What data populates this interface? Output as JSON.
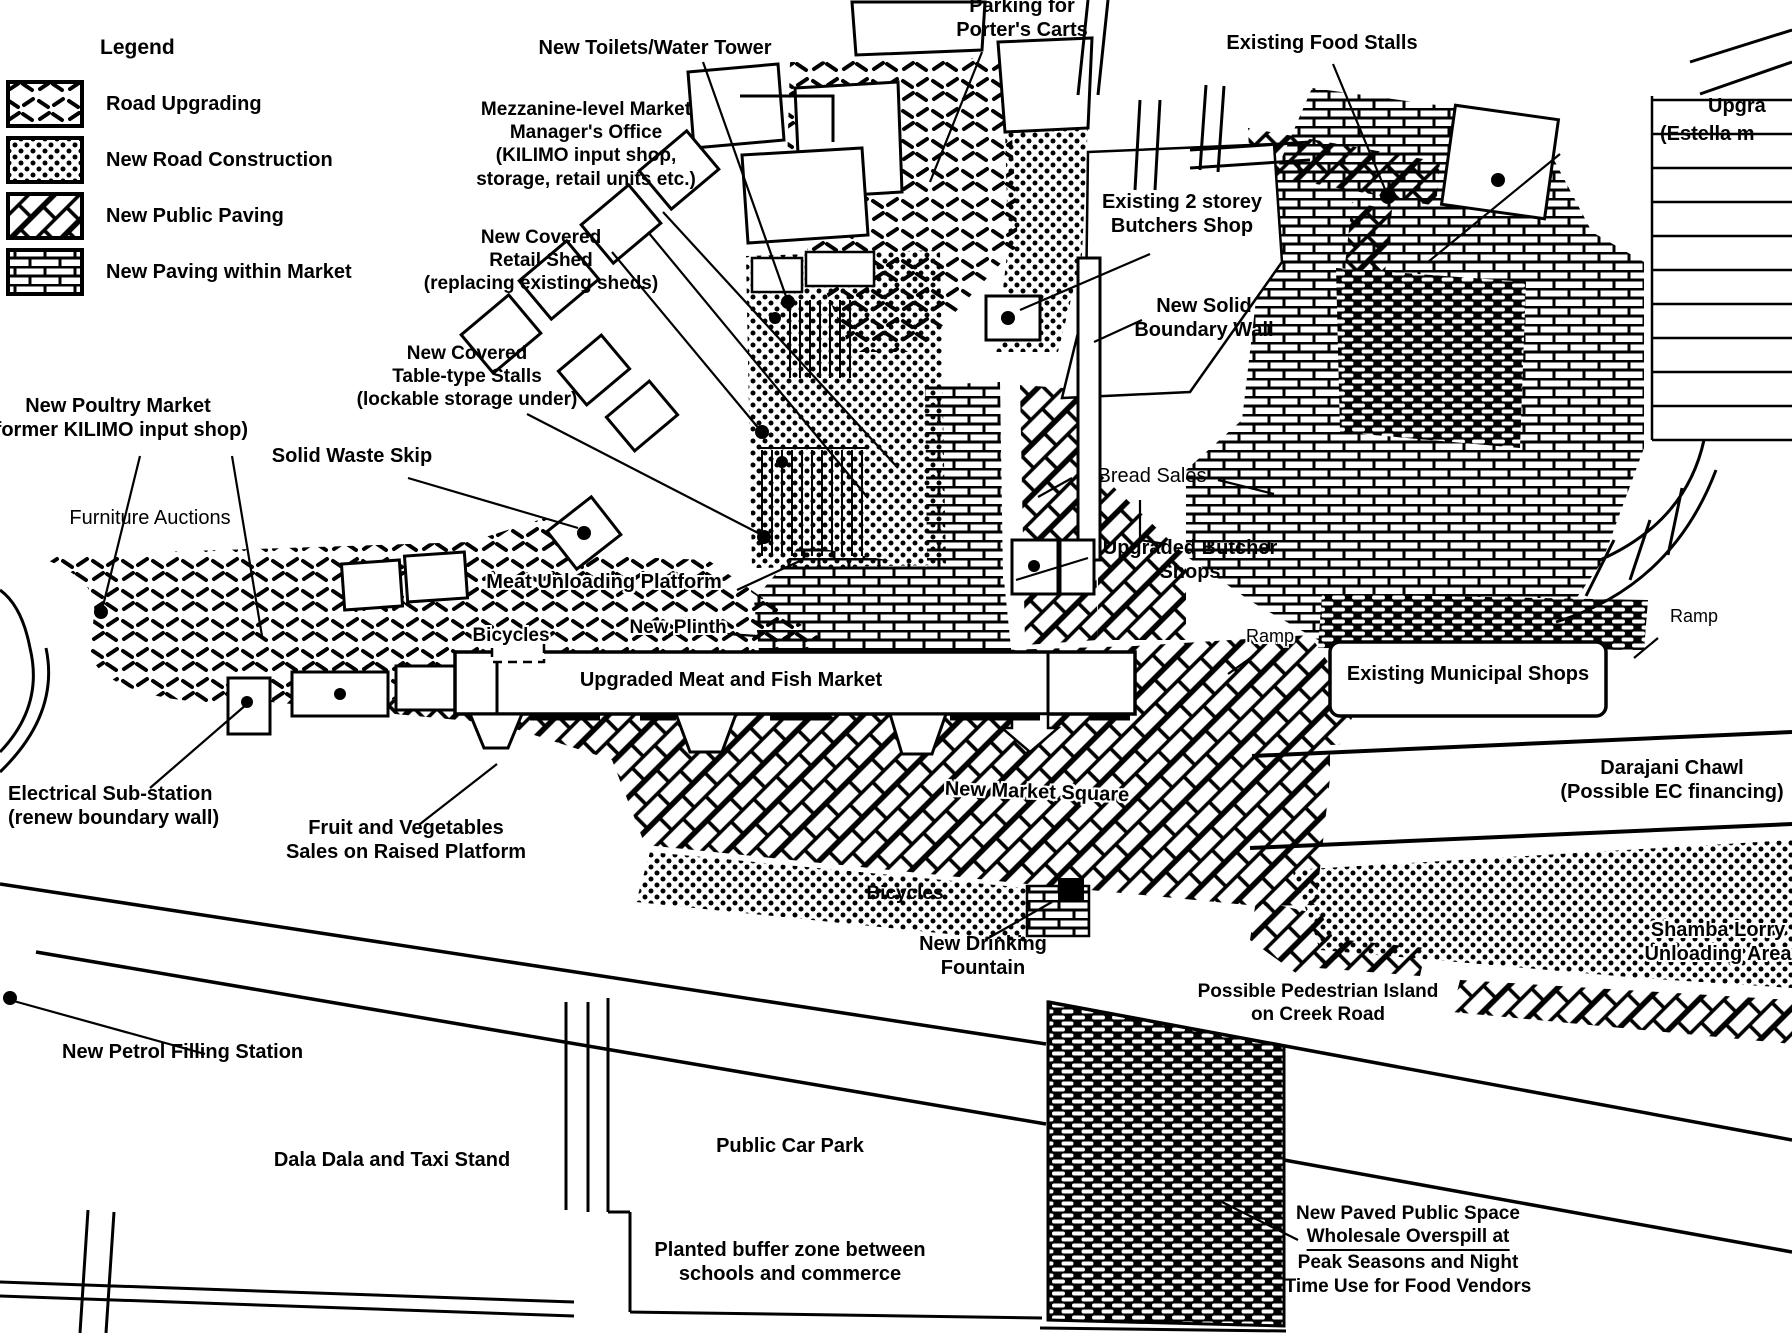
{
  "legend": {
    "title": "Legend",
    "items": [
      {
        "label": "Road Upgrading",
        "pattern": "road-upgrading"
      },
      {
        "label": "New Road Construction",
        "pattern": "new-road-construction"
      },
      {
        "label": "New Public Paving",
        "pattern": "new-public-paving"
      },
      {
        "label": "New Paving within Market",
        "pattern": "new-paving-within-market"
      }
    ]
  },
  "colors": {
    "ink": "#000000",
    "paper": "#ffffff"
  },
  "map_labels": [
    {
      "id": "toilets",
      "lines": [
        "New Toilets/Water Tower"
      ],
      "x": 655,
      "y": 36,
      "size": 20,
      "weight": 600
    },
    {
      "id": "mezzanine-office",
      "lines": [
        "Mezzanine-level Market",
        "Manager's Office",
        "(KILIMO input shop,",
        "storage, retail units etc.)"
      ],
      "x": 586,
      "y": 98,
      "size": 19,
      "weight": 700
    },
    {
      "id": "retail-shed",
      "lines": [
        "New Covered",
        "Retail Shed",
        "(replacing existing sheds)"
      ],
      "x": 541,
      "y": 226,
      "size": 19,
      "weight": 700
    },
    {
      "id": "porters-carts",
      "lines": [
        "Parking for",
        "Porter's Carts"
      ],
      "x": 1022,
      "y": -6,
      "size": 20,
      "weight": 600
    },
    {
      "id": "food-stalls",
      "lines": [
        "Existing Food Stalls"
      ],
      "x": 1322,
      "y": 31,
      "size": 20,
      "weight": 600
    },
    {
      "id": "upgra",
      "lines": [
        "Upgra"
      ],
      "x": 1708,
      "y": 94,
      "size": 20,
      "weight": 600,
      "align": "left"
    },
    {
      "id": "estella",
      "lines": [
        "(Estella m"
      ],
      "x": 1660,
      "y": 122,
      "size": 20,
      "weight": 600,
      "align": "left"
    },
    {
      "id": "butchers-shop",
      "lines": [
        "Existing 2 storey",
        "Butchers Shop"
      ],
      "x": 1182,
      "y": 190,
      "size": 20,
      "weight": 600
    },
    {
      "id": "boundary-wall",
      "lines": [
        "New Solid",
        "Boundary Wall"
      ],
      "x": 1204,
      "y": 294,
      "size": 20,
      "weight": 600
    },
    {
      "id": "table-stalls",
      "lines": [
        "New Covered",
        "Table-type Stalls",
        "(lockable storage under)"
      ],
      "x": 467,
      "y": 342,
      "size": 19,
      "weight": 700
    },
    {
      "id": "poultry-market",
      "lines": [
        "New Poultry Market",
        "(former KILIMO input shop)"
      ],
      "x": 118,
      "y": 394,
      "size": 20,
      "weight": 600
    },
    {
      "id": "waste-skip",
      "lines": [
        "Solid Waste Skip"
      ],
      "x": 352,
      "y": 444,
      "size": 20,
      "weight": 700
    },
    {
      "id": "furniture-auctions",
      "lines": [
        "Furniture Auctions"
      ],
      "x": 150,
      "y": 506,
      "size": 20,
      "weight": 500
    },
    {
      "id": "meat-platform",
      "lines": [
        "Meat Unloading Platform"
      ],
      "x": 604,
      "y": 570,
      "size": 20,
      "weight": 600,
      "halo": true
    },
    {
      "id": "bicycles-1",
      "lines": [
        "Bicycles"
      ],
      "x": 511,
      "y": 624,
      "size": 19,
      "weight": 600,
      "halo": true
    },
    {
      "id": "new-plinth",
      "lines": [
        "New Plinth"
      ],
      "x": 678,
      "y": 616,
      "size": 19,
      "weight": 600,
      "halo": true
    },
    {
      "id": "bread-sales",
      "lines": [
        "Bread Sales"
      ],
      "x": 1152,
      "y": 464,
      "size": 20,
      "weight": 500
    },
    {
      "id": "upgraded-butcher",
      "lines": [
        "Upgraded Butcher",
        "Shops"
      ],
      "x": 1190,
      "y": 536,
      "size": 20,
      "weight": 600
    },
    {
      "id": "ramp-left",
      "lines": [
        "Ramp"
      ],
      "x": 1270,
      "y": 626,
      "size": 18,
      "weight": 500,
      "halo": true
    },
    {
      "id": "municipal-shops",
      "lines": [
        "Existing Municipal Shops"
      ],
      "x": 1468,
      "y": 662,
      "size": 20,
      "weight": 700
    },
    {
      "id": "ramp-right",
      "lines": [
        "Ramp"
      ],
      "x": 1694,
      "y": 606,
      "size": 18,
      "weight": 500
    },
    {
      "id": "meat-fish-market",
      "lines": [
        "Upgraded Meat and Fish Market"
      ],
      "x": 731,
      "y": 668,
      "size": 20,
      "weight": 700
    },
    {
      "id": "market-square",
      "lines": [
        "New Market Square"
      ],
      "x": 1037,
      "y": 780,
      "size": 20,
      "weight": 700,
      "halo": true,
      "rotate": 2
    },
    {
      "id": "electrical",
      "lines": [
        "Electrical Sub-station",
        "(renew boundary wall)"
      ],
      "x": 8,
      "y": 782,
      "size": 20,
      "weight": 600,
      "align": "left"
    },
    {
      "id": "fruit-veg",
      "lines": [
        "Fruit and Vegetables",
        "Sales on Raised Platform"
      ],
      "x": 406,
      "y": 816,
      "size": 20,
      "weight": 700
    },
    {
      "id": "bicycles-2",
      "lines": [
        "Bicycles"
      ],
      "x": 905,
      "y": 882,
      "size": 19,
      "weight": 600
    },
    {
      "id": "fountain",
      "lines": [
        "New Drinking",
        "Fountain"
      ],
      "x": 983,
      "y": 932,
      "size": 20,
      "weight": 600
    },
    {
      "id": "pedestrian-island",
      "lines": [
        "Possible Pedestrian Island",
        "on Creek Road"
      ],
      "x": 1318,
      "y": 980,
      "size": 19,
      "weight": 600
    },
    {
      "id": "darajani-chawl",
      "lines": [
        "Darajani Chawl",
        "(Possible EC financing)"
      ],
      "x": 1672,
      "y": 756,
      "size": 20,
      "weight": 600
    },
    {
      "id": "shamba-lorry",
      "lines": [
        "Shamba Lorry",
        "Unloading Area"
      ],
      "x": 1718,
      "y": 918,
      "size": 20,
      "weight": 700,
      "halo": true
    },
    {
      "id": "petrol-station",
      "lines": [
        "New Petrol Filling Station"
      ],
      "x": 62,
      "y": 1040,
      "size": 20,
      "weight": 700,
      "align": "left"
    },
    {
      "id": "dala-dala",
      "lines": [
        "Dala Dala and Taxi Stand"
      ],
      "x": 392,
      "y": 1148,
      "size": 20,
      "weight": 700
    },
    {
      "id": "car-park",
      "lines": [
        "Public Car Park"
      ],
      "x": 790,
      "y": 1134,
      "size": 20,
      "weight": 700
    },
    {
      "id": "buffer-zone",
      "lines": [
        "Planted buffer zone between",
        "schools and commerce"
      ],
      "x": 790,
      "y": 1238,
      "size": 20,
      "weight": 600
    },
    {
      "id": "paved-space",
      "lines": [
        "New Paved Public Space",
        "Wholesale Overspill at",
        "Peak Seasons and Night",
        "Time Use for Food Vendors"
      ],
      "x": 1408,
      "y": 1202,
      "size": 19,
      "weight": 700,
      "underline_line": 1
    }
  ]
}
